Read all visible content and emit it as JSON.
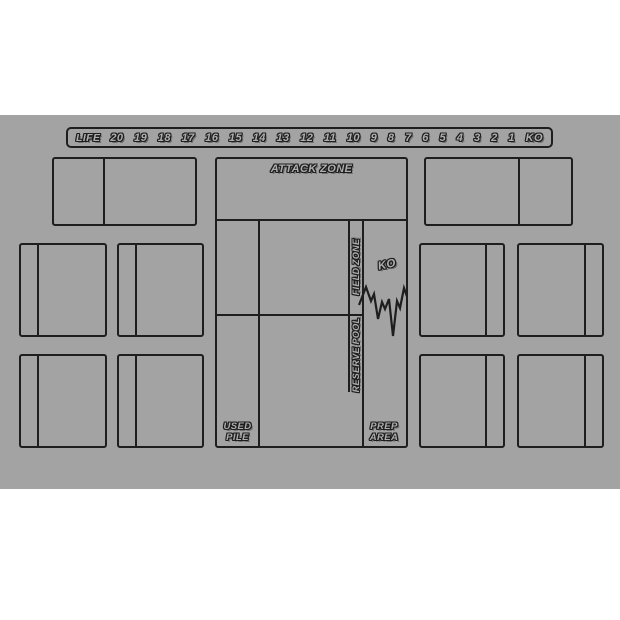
{
  "page": {
    "background_color": "#ffffff"
  },
  "mat": {
    "background_color": "#a3a3a3",
    "line_color": "#1e1e1e"
  },
  "life_track": {
    "label": "LIFE",
    "values": [
      "20",
      "19",
      "18",
      "17",
      "16",
      "15",
      "14",
      "13",
      "12",
      "11",
      "10",
      "9",
      "8",
      "7",
      "6",
      "5",
      "4",
      "3",
      "2",
      "1",
      "KO"
    ]
  },
  "zones": {
    "attack_zone": "ATTACK ZONE",
    "field_zone": "FIELD ZONE",
    "reserve_pool": "RESERVE POOL",
    "ko": "KO",
    "used_pile": [
      "USED",
      "PILE"
    ],
    "prep_area": [
      "PREP",
      "AREA"
    ]
  }
}
